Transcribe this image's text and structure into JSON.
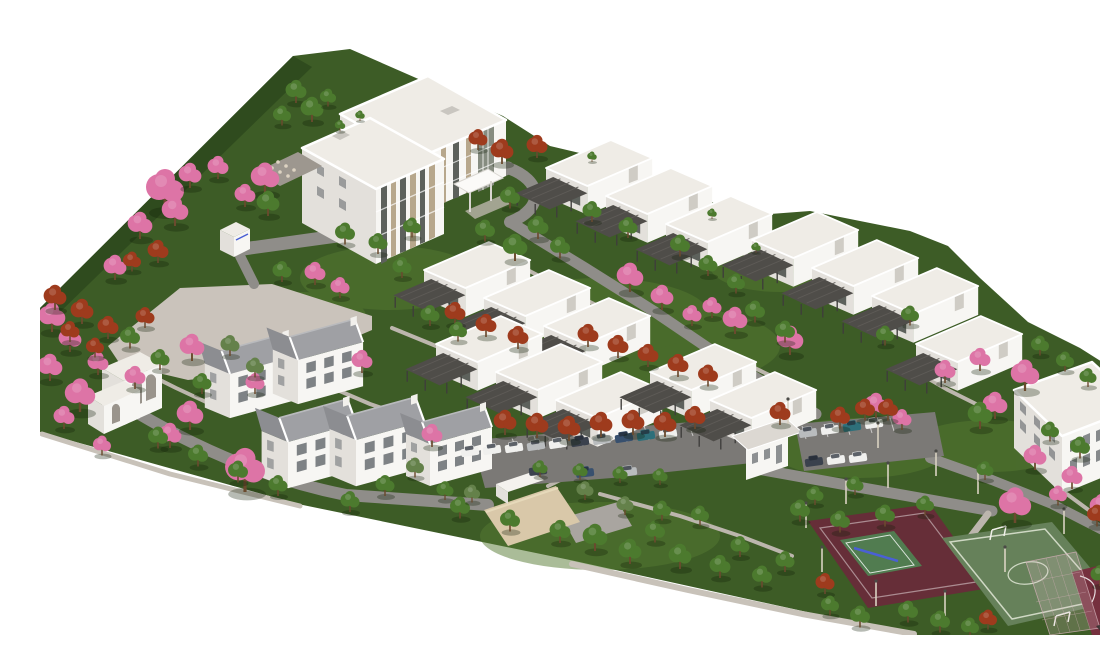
{
  "scene": {
    "title": "Aerial 3D architectural rendering of a residential campus master plan",
    "view": "isometric aerial view on a white background",
    "background": "white",
    "description": "Wedge-shaped landscaped site: a 3-storey main building with glazed entrance tower (top-left), six stepped rows of white flat-roofed villas with dark pergolas, five gabled two-storey houses and an arched community building (west), a 2-storey apartment slab (east), a beige service building, two parking lots with cars, and a sports zone with a maroon multi-use court, tennis court with blue net, green playing field with centre circle and goals, and a basketball court, planted with green, pink-flowering and rust-red trees."
  },
  "inventory": {
    "main_building": "3-storey main building with glazed entrance tower and white canopy",
    "villa_rows": 6,
    "flat_roof_villas": 15,
    "gabled_houses": 5,
    "community_building": "white arched single-storey building",
    "apartment_block": "2-storey white slab block with stone accent",
    "service_building": "beige pitched-roof building",
    "guard_kiosks": 2,
    "parking_lots": 2,
    "cars": 20,
    "sports": [
      "multi-use maroon court",
      "tennis court with blue net",
      "green playing field with centre circle and goals",
      "maroon basketball court with white markings"
    ],
    "landscape": {
      "green_trees": 60,
      "pink_flowering_trees": 30,
      "rust_red_trees": 30,
      "plaza": "paved plaza on the west side",
      "roads": "grey loop roads",
      "paths": "light pedestrian paths",
      "street_lights": 12
    }
  },
  "colors": {
    "background": "#ffffff",
    "grass": "#3d5c26",
    "grass-light": "#567a31",
    "grass-dark": "#2a451b",
    "plaza": "#cac3bb",
    "road": "#8f8d89",
    "path": "#bcb6ad",
    "sidewalk": "#c8c2b9",
    "asphalt": "#7b7976",
    "building-white": "#f7f6f3",
    "building-shade": "#e3e0db",
    "roof-light": "#efece6",
    "roof-gray": "#9fa0a4",
    "pergola": "#4f4d49",
    "glass-dark": "#5d615c",
    "window-dark": "#6a6e72",
    "accent-tan": "#b7a78c",
    "beige-roof": "#d9c8a9",
    "tree-green": "#4c7a2e",
    "tree-olive": "#64814a",
    "tree-pink": "#dd74a6",
    "tree-red": "#9e3b1d",
    "court-maroon": "#662e38",
    "tennis-green": "#517c50",
    "net-blue": "#4a60d4",
    "field-green": "#66815a",
    "bball-maroon": "#75303e",
    "car-white": "#f0f0ee",
    "car-silver": "#b9bcbe",
    "car-dark": "#3a414d",
    "car-blue": "#38506e",
    "car-teal": "#2e6f7a",
    "pole": "#d9d2c2"
  }
}
